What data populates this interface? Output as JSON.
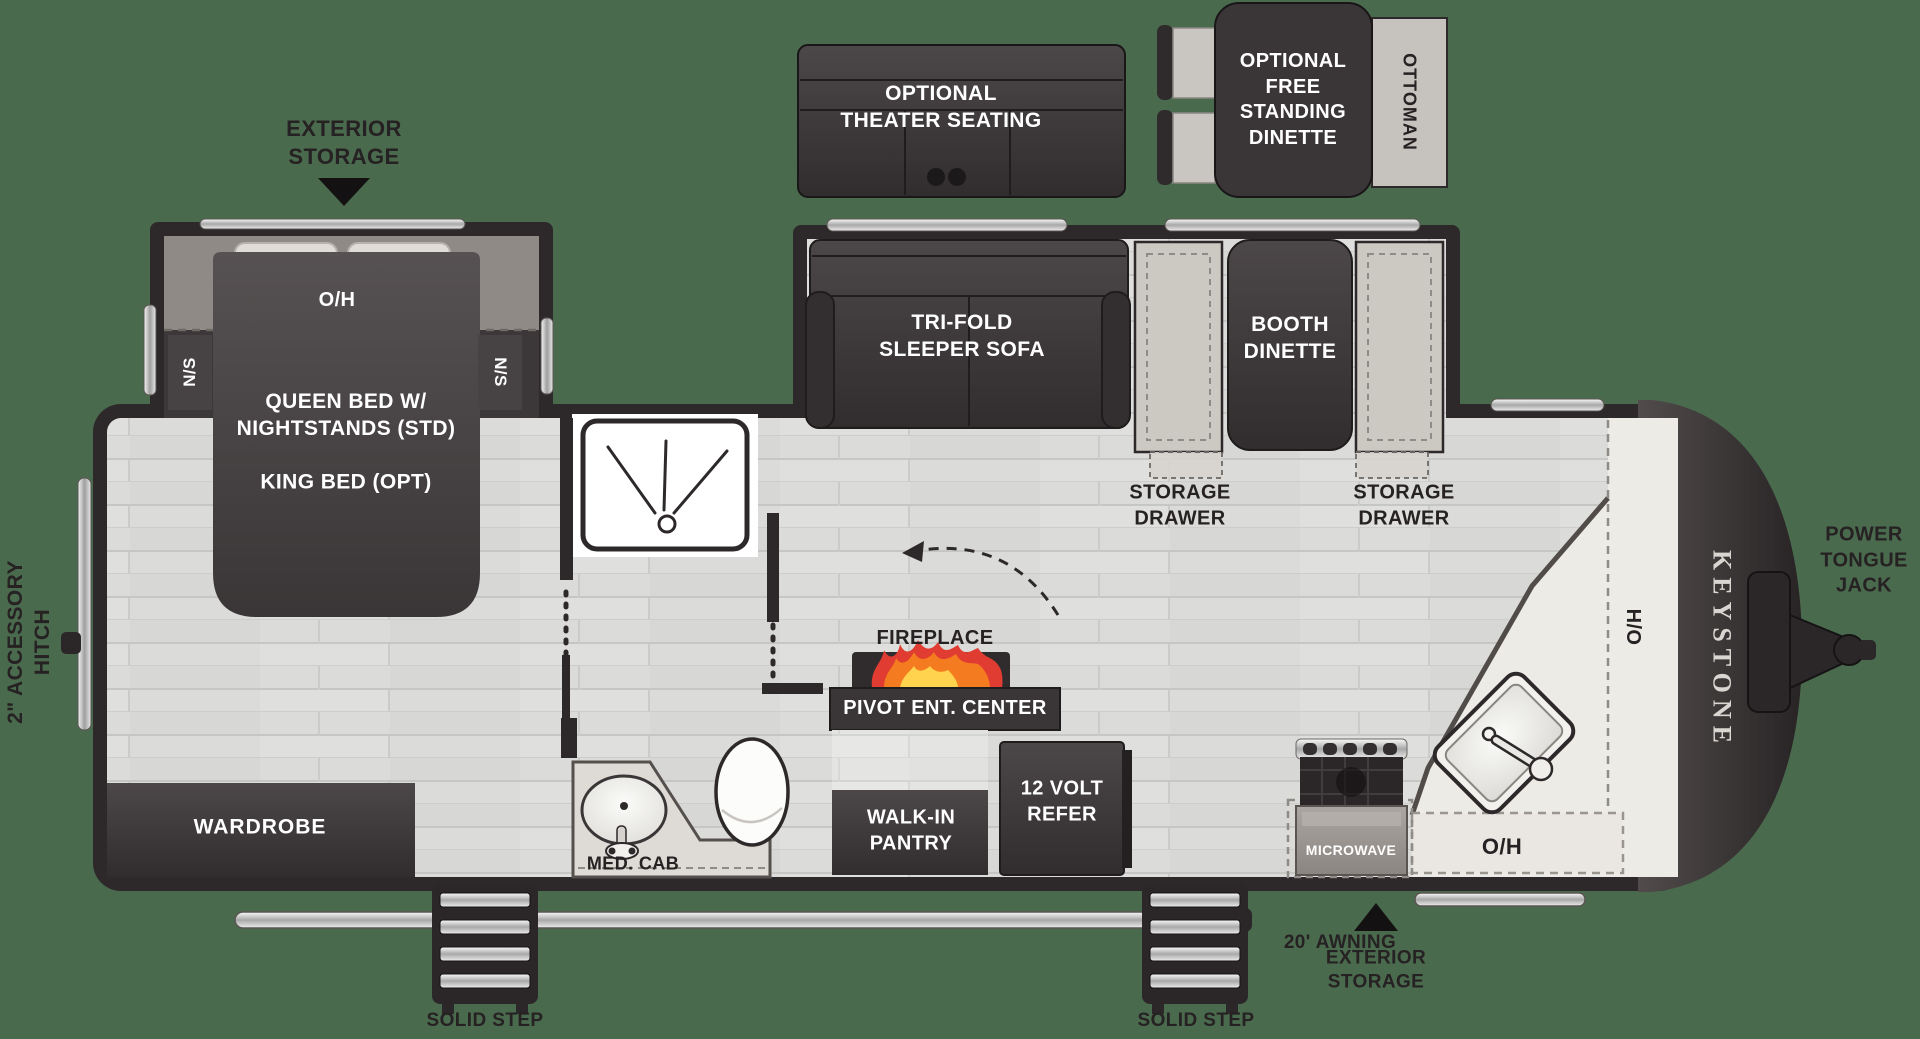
{
  "title": "Keystone travel trailer floor plan",
  "colors": {
    "background": "#4a6a4e",
    "walls": "#2d292a",
    "floor": "#dbdbd9",
    "counter": "#edebe6",
    "bench": "#ccc8c2",
    "overhead_band": "#8f8a85",
    "flame_orange": "#f47b20",
    "flame_red": "#e03c31",
    "flame_yellow": "#ffd34d",
    "chrome": "#c9c9c9",
    "brand_text": "#d9d5d0"
  },
  "labels": {
    "exterior_storage_top": {
      "line1": "EXTERIOR",
      "line2": "STORAGE"
    },
    "theater_seating": {
      "line1": "OPTIONAL",
      "line2": "THEATER SEATING"
    },
    "free_standing_dinette": {
      "line1": "OPTIONAL",
      "line2": "FREE",
      "line3": "STANDING",
      "line4": "DINETTE"
    },
    "ottoman": "OTTOMAN",
    "bedroom_overhead": "O/H",
    "nightstand_left": "N/S",
    "nightstand_right": "N/S",
    "queen_bed": {
      "line1": "QUEEN BED W/",
      "line2": "NIGHTSTANDS (STD)"
    },
    "king_bed": "KING BED (OPT)",
    "accessory_hitch": {
      "line1": "2\" ACCESSORY",
      "line2": "HITCH"
    },
    "tri_fold_sofa": {
      "line1": "TRI-FOLD",
      "line2": "SLEEPER SOFA"
    },
    "booth_dinette": {
      "line1": "BOOTH",
      "line2": "DINETTE"
    },
    "storage_drawer_left": {
      "line1": "STORAGE",
      "line2": "DRAWER"
    },
    "storage_drawer_right": {
      "line1": "STORAGE",
      "line2": "DRAWER"
    },
    "fireplace": "FIREPLACE",
    "pivot_ent_center": "PIVOT ENT. CENTER",
    "walk_in_pantry": {
      "line1": "WALK-IN",
      "line2": "PANTRY"
    },
    "twelve_volt_refer": {
      "line1": "12 VOLT",
      "line2": "REFER"
    },
    "med_cab": "MED. CAB",
    "wardrobe": "WARDROBE",
    "microwave": "MICROWAVE",
    "kitchen_overhead": "O/H",
    "hutch_overhead": "H/O",
    "brand": "KEYSTONE",
    "power_tongue_jack": {
      "line1": "POWER",
      "line2": "TONGUE",
      "line3": "JACK"
    },
    "awning": "20' AWNING",
    "solid_step_left": "SOLID STEP",
    "solid_step_right": "SOLID STEP",
    "exterior_storage_bottom": {
      "line1": "EXTERIOR",
      "line2": "STORAGE"
    }
  }
}
